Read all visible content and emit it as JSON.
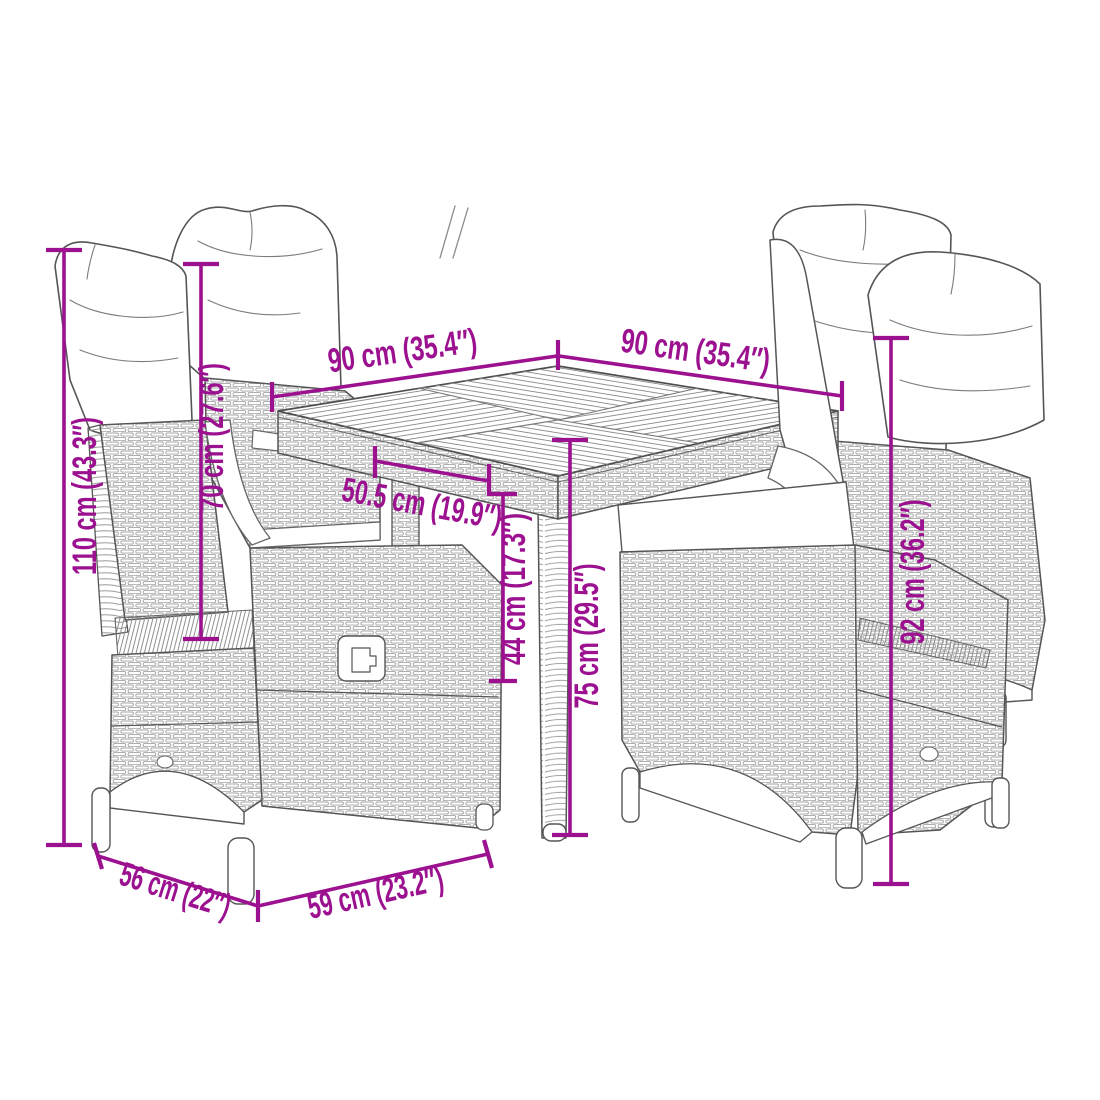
{
  "meta": {
    "image_type": "product-dimension-diagram",
    "product": "garden-dining-set-square-table-4-reclining-chairs"
  },
  "colors": {
    "accent": "#9C1190",
    "line": "#4e4e4e",
    "background": "#ffffff"
  },
  "dimensions": {
    "table_width": {
      "label": "90 cm (35.4″)",
      "value_cm": 90,
      "value_in": 35.4
    },
    "table_depth": {
      "label": "90 cm (35.4″)",
      "value_cm": 90,
      "value_in": 35.4
    },
    "chair_total_height": {
      "label": "110 cm (43.3″)",
      "value_cm": 110,
      "value_in": 43.3
    },
    "backrest_height": {
      "label": "70 cm (27.6″)",
      "value_cm": 70,
      "value_in": 27.6
    },
    "seat_width": {
      "label": "50.5 cm (19.9″)",
      "value_cm": 50.5,
      "value_in": 19.9
    },
    "seat_height": {
      "label": "44 cm (17.3″)",
      "value_cm": 44,
      "value_in": 17.3
    },
    "table_height": {
      "label": "75 cm (29.5″)",
      "value_cm": 75,
      "value_in": 29.5
    },
    "chair_back_height": {
      "label": "92 cm (36.2″)",
      "value_cm": 92,
      "value_in": 36.2
    },
    "chair_depth": {
      "label": "56 cm (22″)",
      "value_cm": 56,
      "value_in": 22
    },
    "chair_width": {
      "label": "59 cm (23.2″)",
      "value_cm": 59,
      "value_in": 23.2
    }
  }
}
